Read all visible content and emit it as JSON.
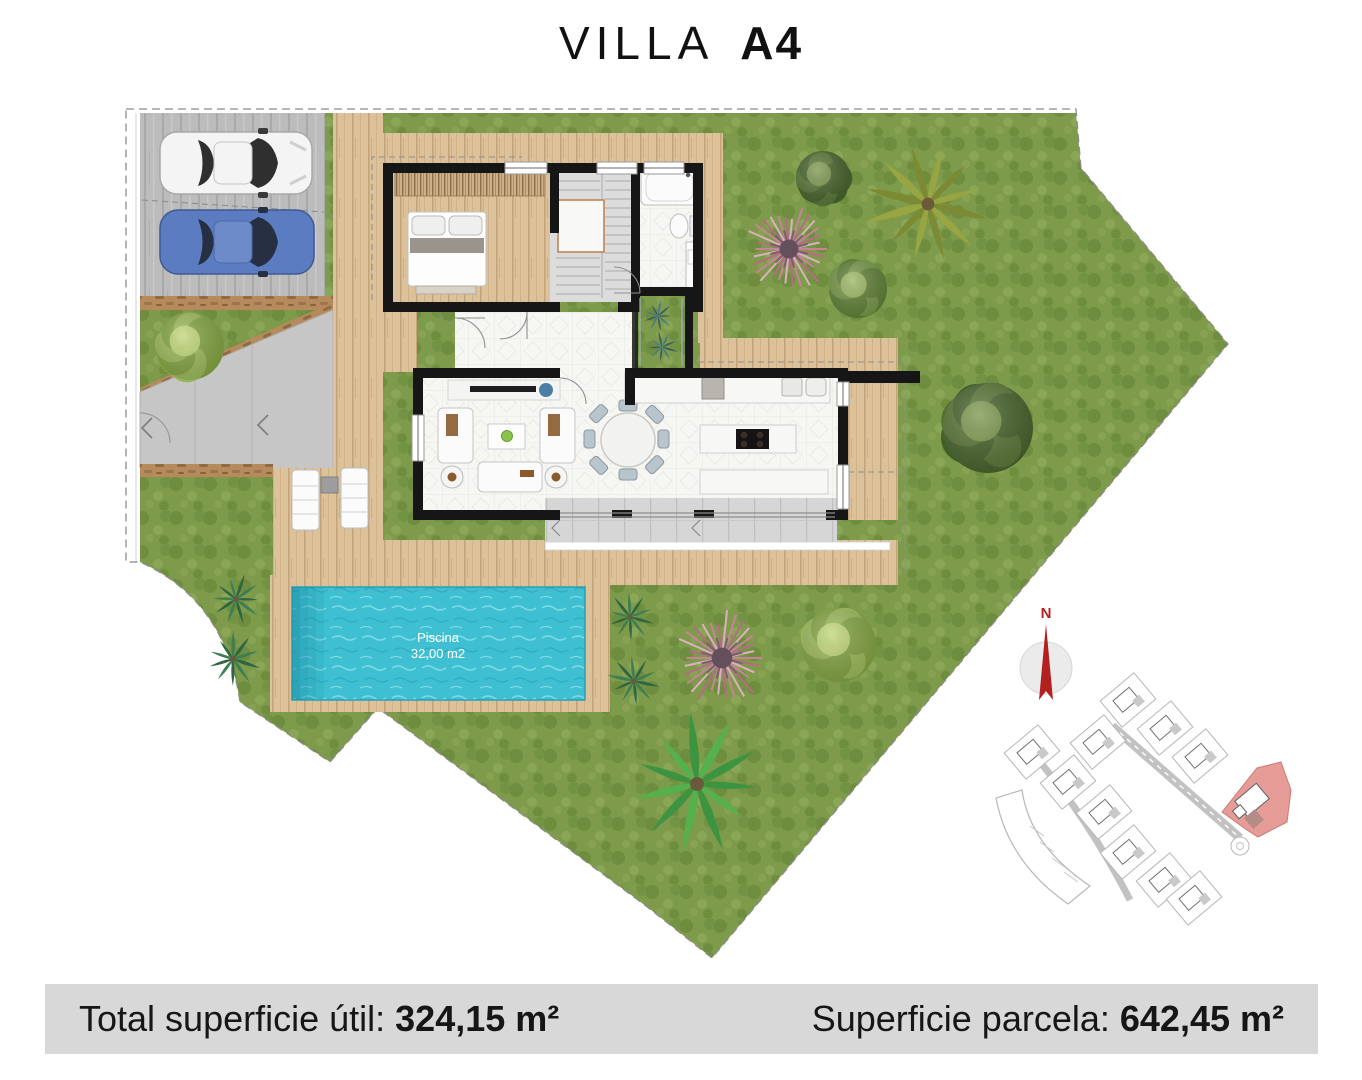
{
  "title": {
    "name": "VILLA",
    "code": "A4"
  },
  "footer": {
    "left_label": "Total superficie útil: ",
    "left_value": "324,15 m²",
    "right_label": "Superficie parcela: ",
    "right_value": "642,45 m²"
  },
  "pool": {
    "name": "Piscina",
    "area": "32,00 m2"
  },
  "compass": {
    "north": "N"
  },
  "colors": {
    "grass": "#7d9b4a",
    "deck": "#dcc29b",
    "water": "#3fc0d2",
    "wall": "#161616",
    "concrete": "#bcbcbc",
    "terrace": "#d6d6d6",
    "path_wood": "#b68a5c",
    "car_white": "#f4f4f4",
    "car_blue": "#5b7cc0",
    "accent_red": "#b32020",
    "highlight": "#e59c96",
    "highlight_stroke": "#c97b74"
  },
  "trees": [
    {
      "type": "bush_lime",
      "x": 190,
      "y": 346,
      "r": 34
    },
    {
      "type": "bush_dark",
      "x": 823,
      "y": 178,
      "r": 27
    },
    {
      "type": "palm_olive",
      "x": 928,
      "y": 204,
      "r": 64
    },
    {
      "type": "pink_tree",
      "x": 789,
      "y": 249,
      "r": 43
    },
    {
      "type": "bush_green",
      "x": 858,
      "y": 289,
      "r": 29
    },
    {
      "type": "bush_dark",
      "x": 988,
      "y": 428,
      "r": 45
    },
    {
      "type": "palm_dark",
      "x": 236,
      "y": 599,
      "r": 26
    },
    {
      "type": "palm_dark",
      "x": 233,
      "y": 659,
      "r": 28
    },
    {
      "type": "palm_dark",
      "x": 630,
      "y": 617,
      "r": 25
    },
    {
      "type": "palm_dark",
      "x": 634,
      "y": 681,
      "r": 27
    },
    {
      "type": "pink_tree",
      "x": 722,
      "y": 658,
      "r": 47
    },
    {
      "type": "bush_lime",
      "x": 839,
      "y": 645,
      "r": 37
    },
    {
      "type": "palm_bright",
      "x": 697,
      "y": 784,
      "r": 70
    },
    {
      "type": "agave",
      "x": 658,
      "y": 316,
      "r": 16
    },
    {
      "type": "agave",
      "x": 662,
      "y": 347,
      "r": 16
    }
  ],
  "sitemap": {
    "plots": [
      {
        "cx": 1128,
        "cy": 700,
        "rot": -40
      },
      {
        "cx": 1165,
        "cy": 728,
        "rot": -40
      },
      {
        "cx": 1200,
        "cy": 756,
        "rot": -40
      },
      {
        "cx": 1032,
        "cy": 752,
        "rot": -40
      },
      {
        "cx": 1068,
        "cy": 782,
        "rot": -40
      },
      {
        "cx": 1104,
        "cy": 812,
        "rot": -40
      },
      {
        "cx": 1128,
        "cy": 852,
        "rot": -40
      },
      {
        "cx": 1164,
        "cy": 880,
        "rot": -40
      },
      {
        "cx": 1098,
        "cy": 742,
        "rot": -40
      },
      {
        "cx": 1194,
        "cy": 898,
        "rot": -40
      }
    ]
  }
}
